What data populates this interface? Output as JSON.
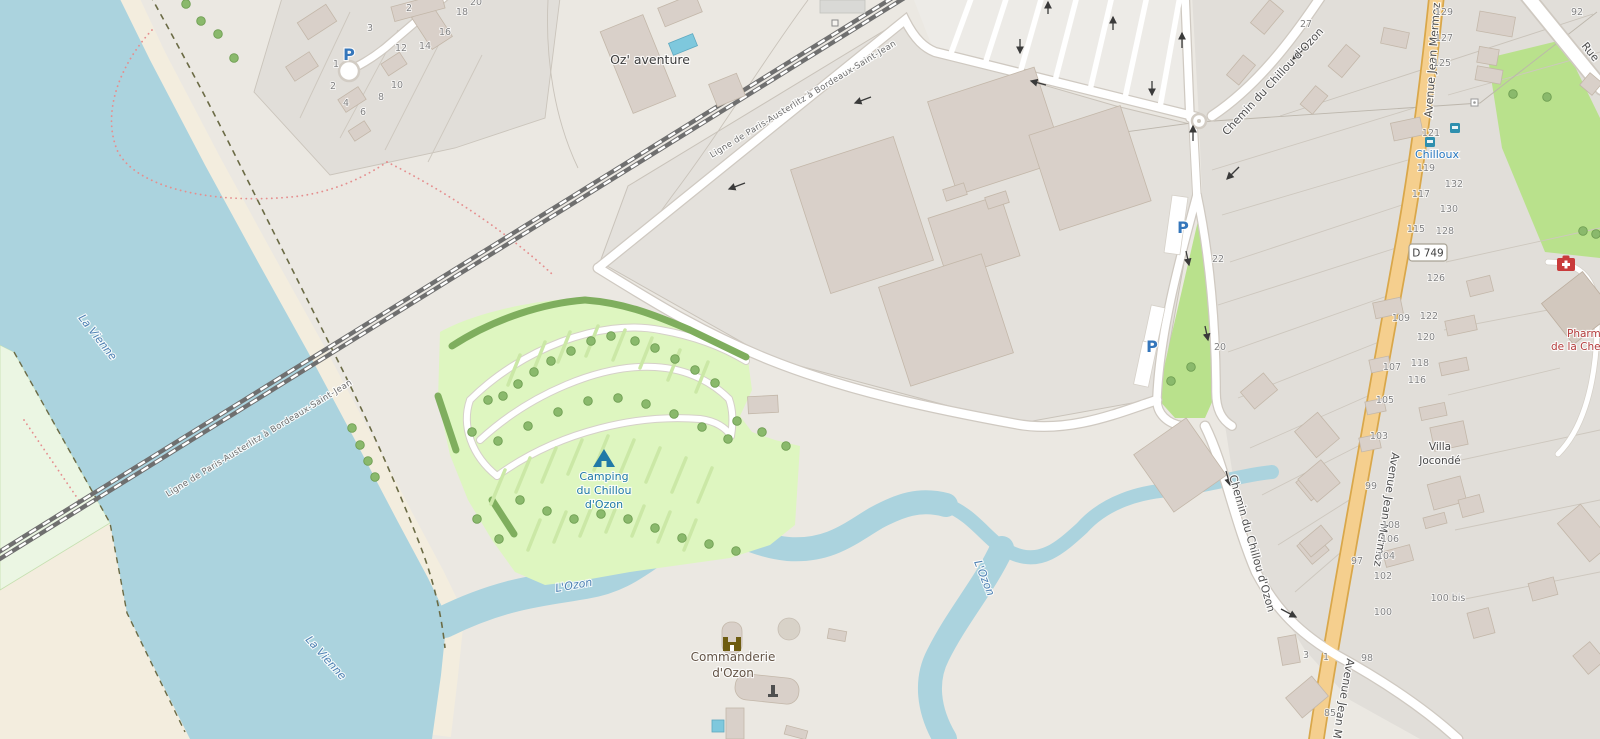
{
  "map": {
    "streets": {
      "avenue": "Avenue Jean Mermoz",
      "chemin": "Chemin du Chillou d'Ozon",
      "rue": "Rue",
      "railway": "Ligne de Paris-Austerlitz à Bordeaux-Saint-Jean",
      "road_ref": "D 749"
    },
    "water": {
      "river": "La Vienne",
      "stream": "L'Ozon"
    },
    "places": {
      "adventure_park": "Oz' aventure",
      "campsite": [
        "Camping",
        "du Chillou",
        "d'Ozon"
      ],
      "commanderie": [
        "Commanderie",
        "d'Ozon"
      ],
      "bus_stop": "Chilloux",
      "pharmacy": [
        "Pharma",
        "de la Che"
      ],
      "villa": [
        "Villa",
        "Jocondé"
      ],
      "parking_symbol": "P"
    },
    "house_numbers": [
      "27",
      "92",
      "129",
      "127",
      "125",
      "121",
      "119",
      "117",
      "115",
      "132",
      "130",
      "128",
      "126",
      "122",
      "120",
      "118",
      "116",
      "109",
      "107",
      "105",
      "103",
      "99",
      "97",
      "108",
      "106",
      "104",
      "102",
      "100 bis",
      "100",
      "98",
      "85",
      "3",
      "1",
      "22",
      "20",
      "2",
      "18",
      "16",
      "14",
      "12",
      "3",
      "1",
      "2",
      "4",
      "6",
      "8",
      "10",
      "20"
    ],
    "colors": {
      "water": "#abd3de",
      "campsite": "#def6c0",
      "grass": "#b9e18c",
      "road_accent": "#f5cf8e",
      "building": "#d9d0c9",
      "camp_label": "#2079a7",
      "water_label": "#4d80b3",
      "pharmacy_label": "#b43c3c",
      "bus_label": "#2677c0"
    }
  }
}
